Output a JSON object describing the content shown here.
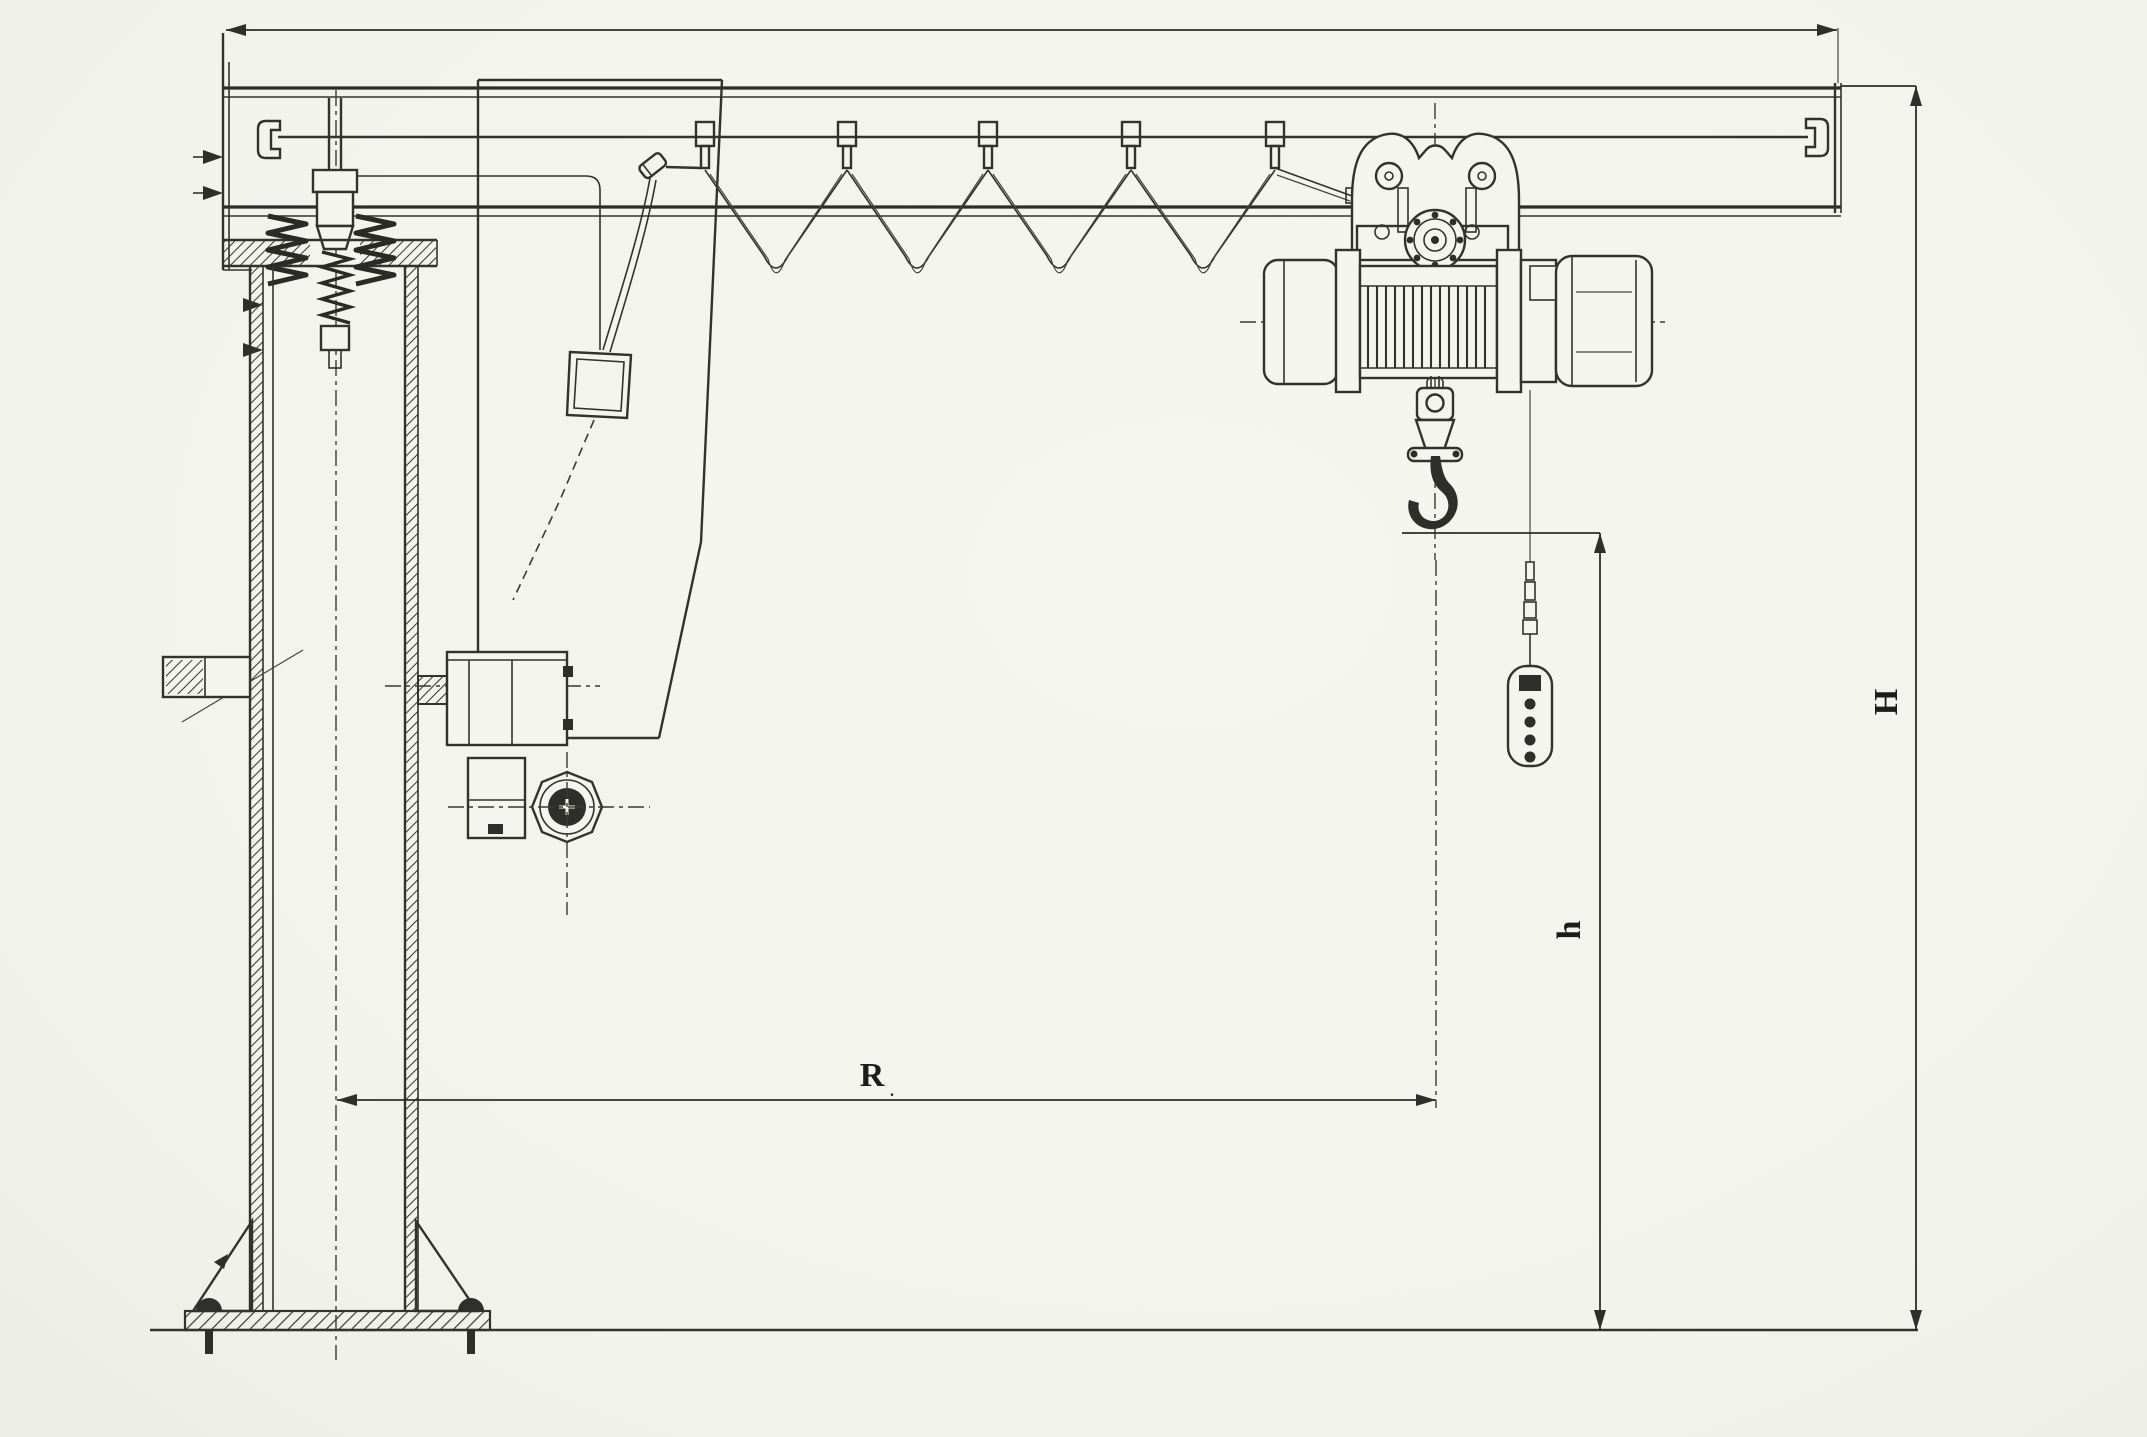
{
  "drawing": {
    "kind": "pillar-jib-crane-general-arrangement",
    "labels": {
      "total_height": "H",
      "hook_height": "h",
      "working_radius": "R",
      "radius_subscript": "."
    },
    "colors": {
      "paper": "#f5f5ef",
      "ink": "#32322e",
      "ink_dark": "#2e2e2a"
    },
    "components": [
      "jib-boom-i-beam",
      "boom-end-stop-left",
      "boom-end-stop-right",
      "slewing-bracket",
      "slewing-kingpin",
      "kingpin-springs",
      "column-cap-flange",
      "support-column",
      "slewing-gearbox",
      "slewing-motor",
      "mounting-stub",
      "festoon-cable-system",
      "cable-hangers",
      "cable-junction-box",
      "hoist-trolley",
      "electric-wire-rope-hoist",
      "rope-drum",
      "hoist-motor",
      "hook-block",
      "lifting-hook",
      "pendant-control",
      "base-plate",
      "anchor-bolts",
      "gusset-plates",
      "floor-line",
      "dimension-total-height",
      "dimension-hook-height",
      "dimension-radius",
      "dimension-span"
    ]
  }
}
